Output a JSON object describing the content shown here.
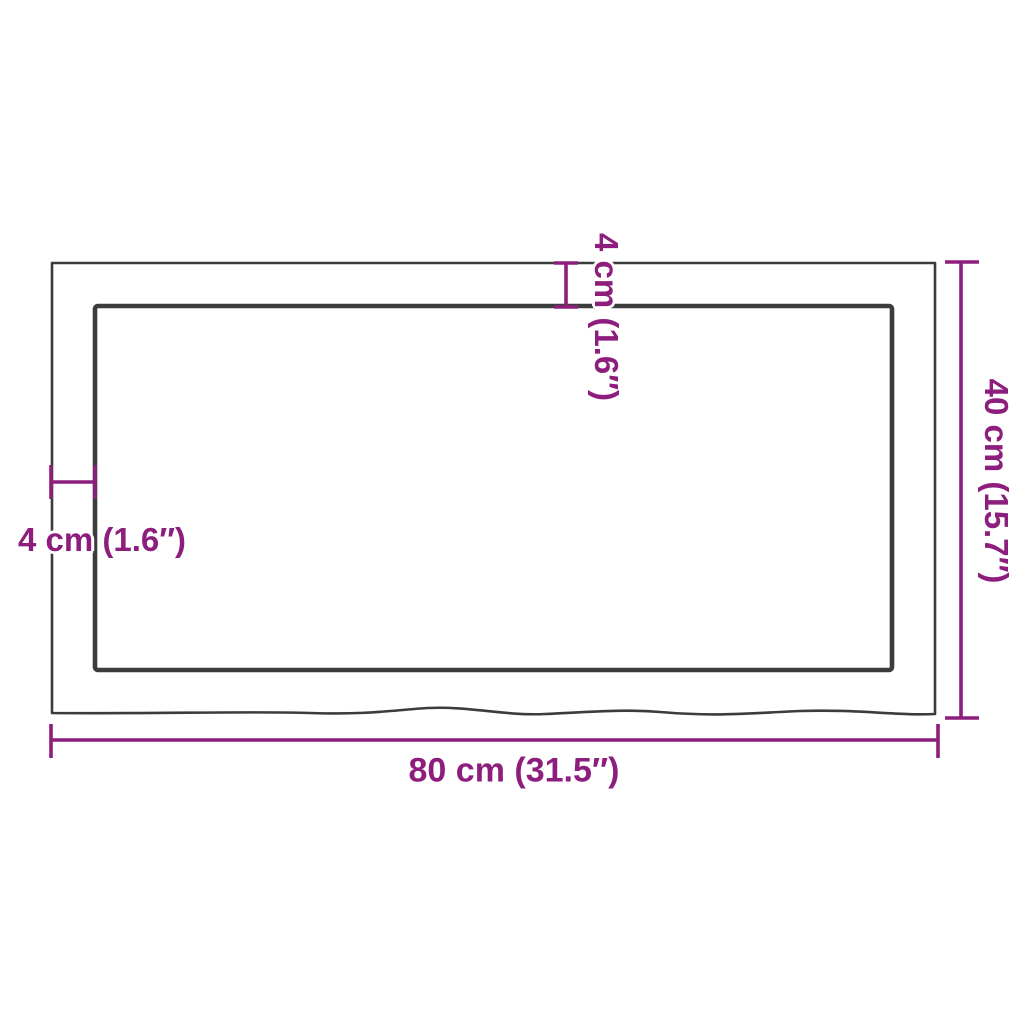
{
  "diagram": {
    "type": "product-dimension-diagram",
    "subject": "rectangular tabletop (live-edge) top view with thickness callouts",
    "labels": {
      "width": "80 cm (31.5″)",
      "height": "40 cm (15.7″)",
      "thickness_top": "4 cm (1.6″)",
      "thickness_left": "4 cm (1.6″)"
    },
    "colors": {
      "dimension_accent": "#8E1E7E",
      "outline": "#3C3C3C",
      "background": "#FFFFFF"
    }
  }
}
